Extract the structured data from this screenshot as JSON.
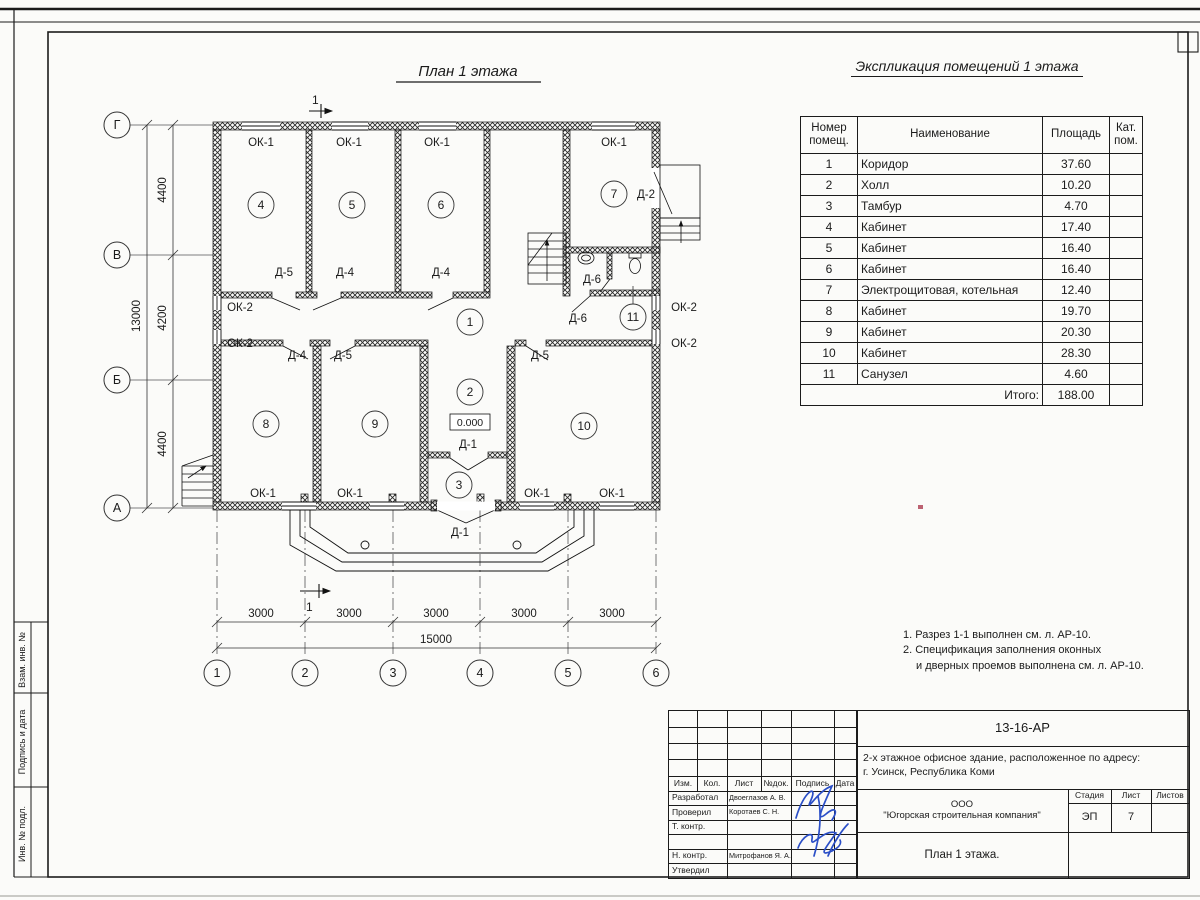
{
  "plan": {
    "title": "План 1 этажа",
    "rooms": {
      "r1": "1",
      "r2": "2",
      "r3": "3",
      "r4": "4",
      "r5": "5",
      "r6": "6",
      "r7": "7",
      "r8": "8",
      "r9": "9",
      "r10": "10",
      "r11": "11"
    },
    "axes": {
      "rows": [
        "Г",
        "В",
        "Б",
        "А"
      ],
      "cols": [
        "1",
        "2",
        "3",
        "4",
        "5",
        "6"
      ]
    },
    "dims": {
      "seg_v": [
        "4400",
        "4200",
        "4400"
      ],
      "total_v": "13000",
      "seg_h": "3000",
      "total_h": "15000"
    },
    "labels": {
      "ok1": "ОК-1",
      "ok2": "ОК-2",
      "d1": "Д-1",
      "d2": "Д-2",
      "d4": "Д-4",
      "d5": "Д-5",
      "d6": "Д-6"
    },
    "level": "0.000",
    "section": "1"
  },
  "schedule": {
    "title": "Экспликация помещений 1 этажа",
    "headers": [
      "Номер помещ.",
      "Наименование",
      "Площадь",
      "Кат. пом."
    ],
    "rows": [
      {
        "num": "1",
        "name": "Коридор",
        "area": "37.60",
        "cat": ""
      },
      {
        "num": "2",
        "name": "Холл",
        "area": "10.20",
        "cat": ""
      },
      {
        "num": "3",
        "name": "Тамбур",
        "area": "4.70",
        "cat": ""
      },
      {
        "num": "4",
        "name": "Кабинет",
        "area": "17.40",
        "cat": ""
      },
      {
        "num": "5",
        "name": "Кабинет",
        "area": "16.40",
        "cat": ""
      },
      {
        "num": "6",
        "name": "Кабинет",
        "area": "16.40",
        "cat": ""
      },
      {
        "num": "7",
        "name": "Электрощитовая, котельная",
        "area": "12.40",
        "cat": ""
      },
      {
        "num": "8",
        "name": "Кабинет",
        "area": "19.70",
        "cat": ""
      },
      {
        "num": "9",
        "name": "Кабинет",
        "area": "20.30",
        "cat": ""
      },
      {
        "num": "10",
        "name": "Кабинет",
        "area": "28.30",
        "cat": ""
      },
      {
        "num": "11",
        "name": "Санузел",
        "area": "4.60",
        "cat": ""
      }
    ],
    "total_label": "Итого:",
    "total": "188.00"
  },
  "notes": {
    "line1": "1. Разрез 1-1 выполнен см. л. АР-10.",
    "line2": "2. Спецификация заполнения оконных",
    "line3": "и дверных проемов выполнена см. л. АР-10."
  },
  "stamp": {
    "doc_number": "13-16-АР",
    "project_line1": "2-х этажное офисное здание, расположенное по адресу:",
    "project_line2": "г. Усинск, Республика Коми",
    "header_cols": [
      "Изм.",
      "Кол.",
      "Лист",
      "№док.",
      "Подпись",
      "Дата"
    ],
    "rows": [
      {
        "role": "Разработал",
        "name": "Двоеглазов А. В."
      },
      {
        "role": "Проверил",
        "name": "Коротаев С. Н."
      },
      {
        "role": "Т. контр.",
        "name": ""
      },
      {
        "role": "",
        "name": ""
      },
      {
        "role": "Н. контр.",
        "name": "Митрофанов Я. А."
      },
      {
        "role": "Утвердил",
        "name": ""
      }
    ],
    "company_line1": "ООО",
    "company_line2": "\"Югорская строительная компания\"",
    "stage_label": "Стадия",
    "sheet_label": "Лист",
    "sheets_label": "Листов",
    "stage": "ЭП",
    "sheet": "7",
    "sheets": "",
    "sheet_title": "План 1 этажа."
  },
  "margin": {
    "c1": "Взам. инв. №",
    "c2": "Подпись и дата",
    "c3": "Инв. № подл."
  }
}
